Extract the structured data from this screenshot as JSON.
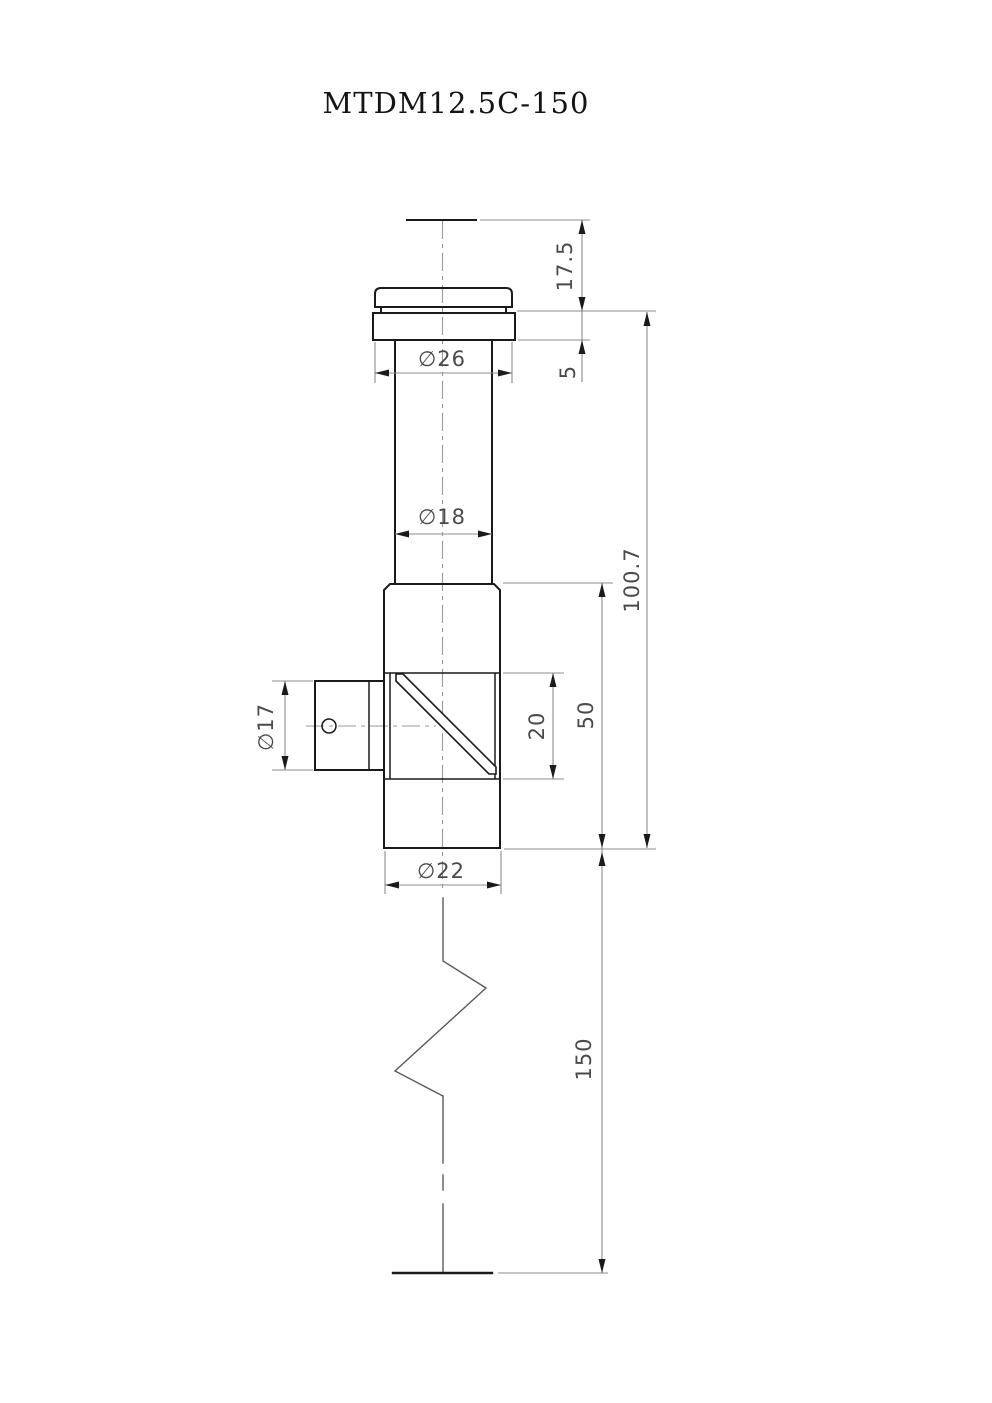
{
  "title": "MTDM12.5C-150",
  "dimensions": {
    "top_offset": "17.5",
    "flange_height": "5",
    "cap_diameter": "∅26",
    "neck_diameter": "∅18",
    "overall_height": "100.7",
    "body_height": "50",
    "aperture_height": "20",
    "port_diameter": "∅17",
    "body_diameter": "∅22",
    "tube_length": "150"
  }
}
